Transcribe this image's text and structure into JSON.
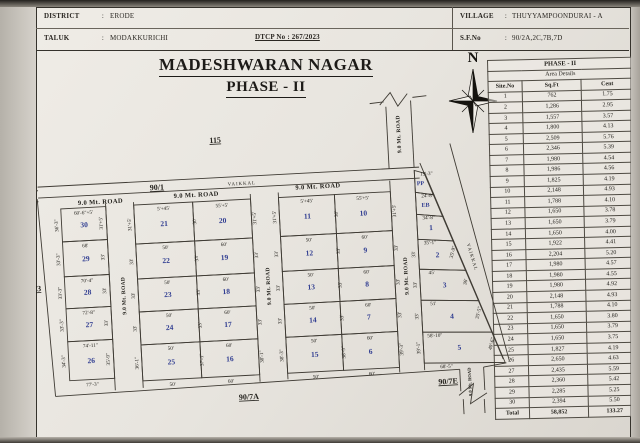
{
  "header": {
    "district_label": "DISTRICT",
    "colon": ":",
    "district": "ERODE",
    "taluk_label": "TALUK",
    "taluk": "MODAKKURICHI",
    "dtcp": "DTCP No : 267/2023",
    "village_label": "VILLAGE",
    "village": "THUYYAMPOONDURAI - A",
    "sfno_label": "S.F.No",
    "sfno": "90/2A,2C,7B,7D"
  },
  "title": {
    "line1": "MADESHWARAN NAGAR",
    "line2": "PHASE - II"
  },
  "compass": {
    "north": "N"
  },
  "area_table": {
    "title": "PHASE - II",
    "subtitle": "Area Details",
    "columns": [
      "Site.No",
      "Sq.Ft",
      "Cent"
    ],
    "rows": [
      [
        "1",
        "762",
        "1.75"
      ],
      [
        "2",
        "1,286",
        "2.95"
      ],
      [
        "3",
        "1,557",
        "3.57"
      ],
      [
        "4",
        "1,800",
        "4.13"
      ],
      [
        "5",
        "2,509",
        "5.76"
      ],
      [
        "6",
        "2,346",
        "5.39"
      ],
      [
        "7",
        "1,980",
        "4.54"
      ],
      [
        "8",
        "1,986",
        "4.56"
      ],
      [
        "9",
        "1,825",
        "4.19"
      ],
      [
        "10",
        "2,148",
        "4.93"
      ],
      [
        "11",
        "1,788",
        "4.10"
      ],
      [
        "12",
        "1,650",
        "3.78"
      ],
      [
        "13",
        "1,650",
        "3.79"
      ],
      [
        "14",
        "1,650",
        "4.00"
      ],
      [
        "15",
        "1,922",
        "4.41"
      ],
      [
        "16",
        "2,204",
        "5.20"
      ],
      [
        "17",
        "1,980",
        "4.57"
      ],
      [
        "18",
        "1,980",
        "4.55"
      ],
      [
        "19",
        "1,980",
        "4.92"
      ],
      [
        "20",
        "2,148",
        "4.93"
      ],
      [
        "21",
        "1,788",
        "4.10"
      ],
      [
        "22",
        "1,650",
        "3.80"
      ],
      [
        "23",
        "1,650",
        "3.79"
      ],
      [
        "24",
        "1,650",
        "3.75"
      ],
      [
        "25",
        "1,827",
        "4.19"
      ],
      [
        "26",
        "2,650",
        "4.63"
      ],
      [
        "27",
        "2,435",
        "5.59"
      ],
      [
        "28",
        "2,360",
        "5.42"
      ],
      [
        "29",
        "2,285",
        "5.25"
      ],
      [
        "30",
        "2,394",
        "5.50"
      ]
    ],
    "total_label": "Total",
    "total_sqft": "58,852",
    "total_cent": "133.27"
  },
  "plan": {
    "road_label": "9.0 Mt. ROAD",
    "labels": {
      "s115": "115",
      "s90_1": "90/1",
      "s90_3": "90/3",
      "s90_7a": "90/7A",
      "s90_7e": "90/7E",
      "vaikkal": "VAIKKAL"
    },
    "block_a": [
      {
        "num": "30",
        "top": "60'-6\"+5'",
        "left": "36'-3\"",
        "right": "31'+5'"
      },
      {
        "num": "29",
        "top": "68'",
        "left": "33'-3\"",
        "right": "33'"
      },
      {
        "num": "28",
        "top": "70'-4\"",
        "left": "33'-3\"",
        "right": "33'"
      },
      {
        "num": "27",
        "top": "72'-8\"",
        "left": "33'-3\"",
        "right": "33'"
      },
      {
        "num": "26",
        "top": "74'-11\"",
        "left": "34'-3\"",
        "right": "35'-9\"",
        "bottom": "77'-3\""
      }
    ],
    "block_b_left": [
      {
        "num": "21",
        "top": "5'+45'",
        "left": "31'+5'"
      },
      {
        "num": "22",
        "top": "50'",
        "left": "33'"
      },
      {
        "num": "23",
        "top": "50'",
        "left": "33'"
      },
      {
        "num": "24",
        "top": "50'",
        "left": "33'"
      },
      {
        "num": "25",
        "top": "50'",
        "left": "36'-1\"",
        "bottom": "50'"
      }
    ],
    "block_b_mid": [
      "30'",
      "33'",
      "33'",
      "33'",
      "37'-1\""
    ],
    "block_b_right": [
      {
        "num": "20",
        "top": "55'+5'",
        "right": "31'+5'"
      },
      {
        "num": "19",
        "top": "60'",
        "right": "33'"
      },
      {
        "num": "18",
        "top": "60'",
        "right": "33'"
      },
      {
        "num": "17",
        "top": "60'",
        "right": "33'"
      },
      {
        "num": "16",
        "top": "60'",
        "right": "38'-1\"",
        "bottom": "60'"
      }
    ],
    "block_c_left": [
      {
        "num": "11",
        "top": "5'+45'",
        "left": "31'+5'"
      },
      {
        "num": "12",
        "top": "50'",
        "left": "33'"
      },
      {
        "num": "13",
        "top": "50'",
        "left": "33'"
      },
      {
        "num": "14",
        "top": "50'",
        "left": "33'"
      },
      {
        "num": "15",
        "top": "50'",
        "left": "38'-3\"",
        "bottom": "50'"
      }
    ],
    "block_c_mid": [
      "30'",
      "33'",
      "33'",
      "33'",
      "38'-9\""
    ],
    "block_c_right": [
      {
        "num": "10",
        "top": "55'+5'",
        "right": "31'+5'"
      },
      {
        "num": "9",
        "top": "60'",
        "right": "33'"
      },
      {
        "num": "8",
        "top": "60'",
        "right": "33'"
      },
      {
        "num": "7",
        "top": "60'",
        "right": "33'"
      },
      {
        "num": "6",
        "top": "60'",
        "right": "39'-3\"",
        "bottom": "60'"
      }
    ],
    "strip": [
      {
        "num": "PP",
        "top": "19'-3\""
      },
      {
        "num": "EB",
        "top": "24'-8\""
      },
      {
        "num": "1",
        "top": "34'-8\""
      },
      {
        "num": "2",
        "top": "35'-1\"",
        "left": "33'",
        "right": "35'-9\""
      },
      {
        "num": "3",
        "top": "45'",
        "left": "33'",
        "right": "36'"
      },
      {
        "num": "4",
        "top": "51'",
        "left": "33'",
        "right": "35'-5\""
      },
      {
        "num": "5",
        "top": "58'-10\"",
        "left": "39'-1\"",
        "right": "40'-6\"",
        "bottom": "68'-5\""
      }
    ]
  }
}
